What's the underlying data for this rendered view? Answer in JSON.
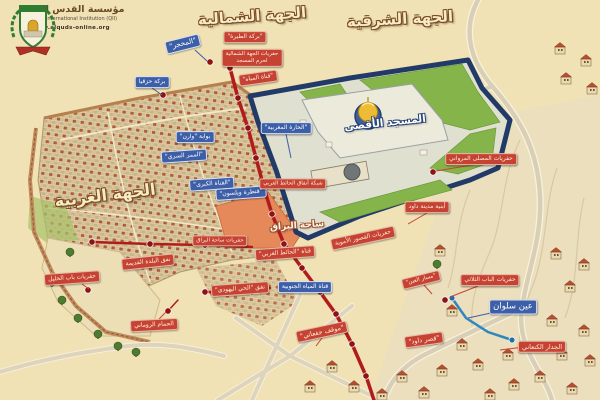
{
  "logo": {
    "org_name_ar": "مؤسسة القدس الدولية",
    "org_name_en": "al-Quds International Institution (QII)",
    "website": "www.alquds-online.org"
  },
  "colors": {
    "background": "#f0e2b4",
    "label_blue": "#3d5fa8",
    "label_red": "#c64334",
    "wall_navy": "#223a68",
    "dome_gold": "#e9b32a",
    "lawn_green": "#85b54a",
    "route_red": "#b01c1c",
    "water_blue": "#2e86c1"
  },
  "titles": [
    {
      "name": "region-title-north",
      "text": "الجهة الشمالية",
      "x": 252,
      "y": 16,
      "size": 15,
      "rot": -4,
      "style": "gold"
    },
    {
      "name": "region-title-east",
      "text": "الجهة الشرقية",
      "x": 400,
      "y": 19,
      "size": 15,
      "rot": -3,
      "style": "gold"
    },
    {
      "name": "region-title-west",
      "text": "الجهة الغربية",
      "x": 105,
      "y": 195,
      "size": 16,
      "rot": -7,
      "style": "gold"
    },
    {
      "name": "title-aqsa-mosque",
      "text": "المسجد الأقصى",
      "x": 385,
      "y": 123,
      "size": 10.5,
      "rot": -6,
      "style": "navy"
    },
    {
      "name": "title-buraq-plaza",
      "text": "ساحة البراق",
      "x": 297,
      "y": 226,
      "size": 9,
      "rot": -4,
      "style": "rust"
    }
  ],
  "labels": [
    {
      "name": "quarry-label",
      "type": "blue",
      "text": "\"المحجر\"",
      "x": 183,
      "y": 44,
      "rot": -14,
      "size": 7
    },
    {
      "name": "hezekiah-pool-label",
      "type": "blue",
      "text": "بركة حزقيا",
      "x": 152,
      "y": 82,
      "rot": 0,
      "size": 6
    },
    {
      "name": "warren-gate-label",
      "type": "blue",
      "text": "بوابة \"وارن\"",
      "x": 195,
      "y": 137,
      "rot": 0,
      "size": 6
    },
    {
      "name": "secret-passage-label",
      "type": "blue",
      "text": "\"الممر السري\"",
      "x": 184,
      "y": 156,
      "rot": -4,
      "size": 6
    },
    {
      "name": "great-channel-label",
      "type": "blue",
      "text": "\"القناة الكبرى\"",
      "x": 212,
      "y": 184,
      "rot": -4,
      "size": 6
    },
    {
      "name": "wilson-arch-label",
      "type": "blue",
      "text": "\"قنطرة ويلسون\"",
      "x": 241,
      "y": 193,
      "rot": -4,
      "size": 6
    },
    {
      "name": "mughrabi-quarter-label",
      "type": "blue",
      "text": "\"الحارة المغربية\"",
      "x": 286,
      "y": 128,
      "rot": 0,
      "size": 6
    },
    {
      "name": "south-water-channel-label",
      "type": "blue",
      "text": "قناة المياه الجنوبية",
      "x": 305,
      "y": 287,
      "rot": 0,
      "size": 6
    },
    {
      "name": "silwan-spring-label",
      "type": "blue",
      "text": "عين سلوان",
      "x": 513,
      "y": 307,
      "rot": 0,
      "size": 8.5
    },
    {
      "name": "tira-pool-label",
      "type": "red",
      "text": "\"بركة الطيرة\"",
      "x": 245,
      "y": 37,
      "rot": 0,
      "size": 6
    },
    {
      "name": "north-excavations-label",
      "type": "red",
      "text": "حفريات الجهة الشمالية\nلحرم المسجد",
      "x": 252,
      "y": 58,
      "rot": 0,
      "size": 5.5
    },
    {
      "name": "water-channel-label",
      "type": "red",
      "text": "\"قناة المياه\"",
      "x": 258,
      "y": 78,
      "rot": -8,
      "size": 6
    },
    {
      "name": "western-wall-tunnels-label",
      "type": "red",
      "text": "شبكة أنفاق الحائط الغربي",
      "x": 293,
      "y": 184,
      "rot": 0,
      "size": 5.5
    },
    {
      "name": "western-wall-channel-label",
      "type": "red",
      "text": "قناة \"الحائط الغربي\"",
      "x": 285,
      "y": 253,
      "rot": -4,
      "size": 6
    },
    {
      "name": "umayyad-palaces-label",
      "type": "red",
      "text": "حفريات القصور الأموية",
      "x": 363,
      "y": 238,
      "rot": -12,
      "size": 6
    },
    {
      "name": "marwani-prayer-hall-label",
      "type": "red",
      "text": "حفريات المصلى المرواني",
      "x": 481,
      "y": 159,
      "rot": 0,
      "size": 6
    },
    {
      "name": "david-city-buildings-label",
      "type": "red",
      "text": "أبنية مدينة داود",
      "x": 427,
      "y": 207,
      "rot": 0,
      "size": 6
    },
    {
      "name": "triple-gate-excavations-label",
      "type": "red",
      "text": "حفريات الباب الثلاثي",
      "x": 490,
      "y": 280,
      "rot": 0,
      "size": 6
    },
    {
      "name": "spring-path-label",
      "type": "red",
      "text": "\"مسار العين\"",
      "x": 421,
      "y": 280,
      "rot": -14,
      "size": 5.5
    },
    {
      "name": "canaanite-wall-label",
      "type": "red",
      "text": "الجدار الكنعاني",
      "x": 542,
      "y": 347,
      "rot": 0,
      "size": 6.5
    },
    {
      "name": "givati-parking-label",
      "type": "red",
      "text": "\"موقف جفعاتي\"",
      "x": 322,
      "y": 332,
      "rot": -12,
      "size": 6.5
    },
    {
      "name": "david-palace-label",
      "type": "red",
      "text": "\"قصر داود\"",
      "x": 424,
      "y": 340,
      "rot": -8,
      "size": 6.5
    },
    {
      "name": "jewish-quarter-tunnel-label",
      "type": "red",
      "text": "نفق \"الحي اليهودي\"",
      "x": 240,
      "y": 289,
      "rot": -4,
      "size": 6
    },
    {
      "name": "buraq-plaza-excavations-label",
      "type": "red",
      "text": "حفريات ساحة البراق",
      "x": 220,
      "y": 241,
      "rot": 0,
      "size": 5.5
    },
    {
      "name": "old-city-tunnel-label",
      "type": "red",
      "text": "نفق البلدة القديمة",
      "x": 148,
      "y": 262,
      "rot": -6,
      "size": 6
    },
    {
      "name": "jaffa-gate-excavations-label",
      "type": "red",
      "text": "حفريات باب الخليل",
      "x": 72,
      "y": 278,
      "rot": -4,
      "size": 6
    },
    {
      "name": "roman-bath-label",
      "type": "red",
      "text": "الحمام الروماني",
      "x": 154,
      "y": 325,
      "rot": -3,
      "size": 6
    }
  ]
}
